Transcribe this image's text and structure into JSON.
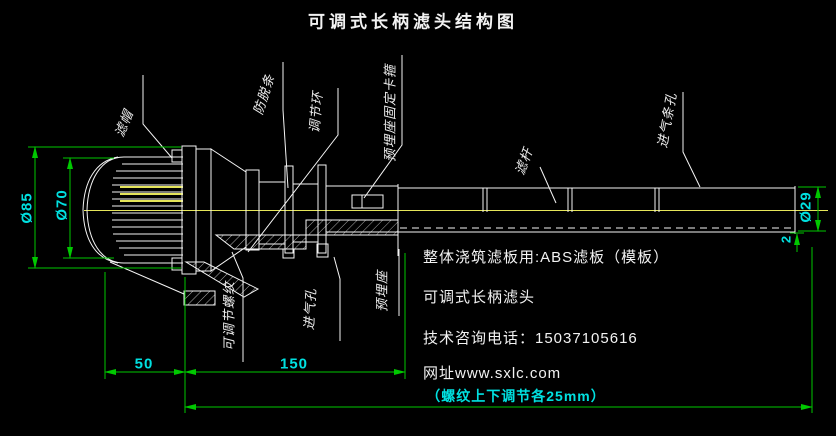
{
  "title": "可调式长柄滤头结构图",
  "colors": {
    "background": "#000000",
    "line": "#f5f5f5",
    "dimension": "#00c800",
    "dimension_text": "#00e0e0",
    "highlight": "#e6e65a",
    "label_text": "#ededed",
    "note_text": "#f2f2f2"
  },
  "part_labels": {
    "filter_cap": "滤帽",
    "anti_release_strip": "防脱条",
    "adjusting_ring": "调节环",
    "embed_clamp": "预埋座固定卡箍",
    "filter_rod": "滤杆",
    "air_slot_holes": "进气条孔",
    "adjustable_thread": "可调节螺纹",
    "air_hole": "进气孔",
    "embedded_seat": "预埋座"
  },
  "dimensions": {
    "flange_od": "Ø85",
    "cap_od": "Ø70",
    "rod_od": "Ø29",
    "wall_thickness": "2",
    "cap_length": "50",
    "embed_length": "150",
    "thread_note": "（螺纹上下调节各25mm）"
  },
  "notes": {
    "line1": "整体浇筑滤板用:ABS滤板（模板）",
    "line2": "可调式长柄滤头",
    "line3": "技术咨询电话：15037105616",
    "line4": "网址www.sxlc.com"
  }
}
